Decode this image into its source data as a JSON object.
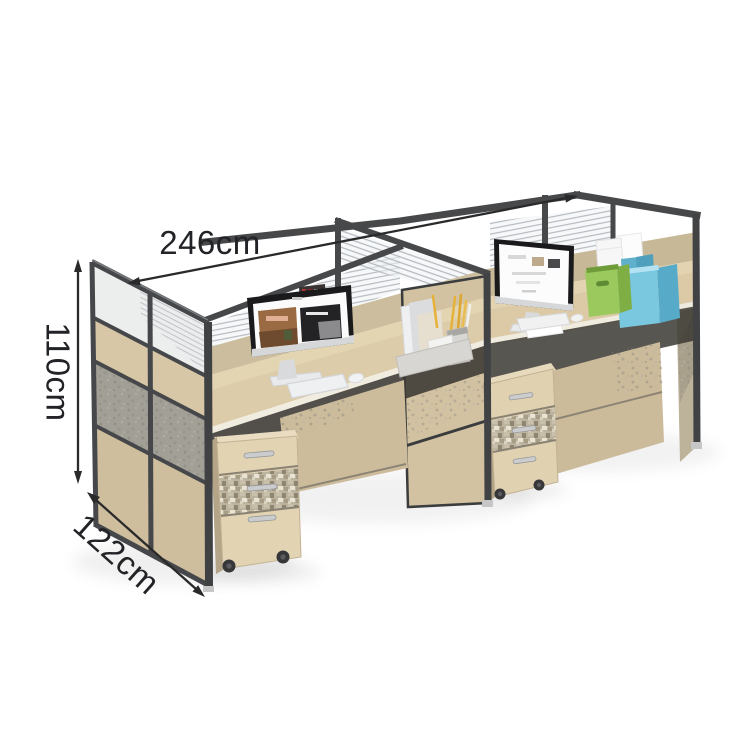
{
  "page": {
    "title": "Office workstation product dimension illustration",
    "background_color": "#ffffff"
  },
  "annotations": {
    "width_label": "246cm",
    "height_label": "110cm",
    "depth_label": "122cm",
    "line_color": "#2a2a2b"
  },
  "palette": {
    "frame_metal": "#46484a",
    "desk_wood": "#ddcca9",
    "panel_wood": "#d6c5a3",
    "panel_fabric_gray": "#a19e95",
    "glass_stripe": "#b6bac0",
    "modesty_wood": "#cdbc9b",
    "mosaic_drawer": "#bdb4a0",
    "monitor_bezel": "#1a1a1c",
    "box_green": "#9cc95d",
    "box_green_dark": "#7fae45",
    "box_blue": "#7ac7e0",
    "box_blue_dark": "#58abc8",
    "pencil_yellow": "#e5b23c",
    "caster_dark": "#37373a"
  },
  "scene": {
    "description": "Four-person office cubicle workstation with metal-framed partitions (clear glass tops, louvered glass screens, wood and gray fabric panels), two light-wood desks with iMac-style monitors, keyboards and mice, a desktop file organizer with pencils, green and blue storage boxes with white boxes on top, and two mobile three-drawer pedestals on casters.",
    "elements": [
      "left-end-partition",
      "center-partition",
      "right-end-partition",
      "partition-top-frame",
      "louvered-glass-screen",
      "left-desk",
      "right-desk",
      "monitor-left",
      "monitor-right",
      "keyboard-left",
      "keyboard-right",
      "mouse-left",
      "mouse-right",
      "desk-organizer",
      "pencils",
      "green-storage-box",
      "blue-storage-box",
      "white-boxes",
      "pedestal-left",
      "pedestal-right",
      "caster-wheels"
    ]
  }
}
